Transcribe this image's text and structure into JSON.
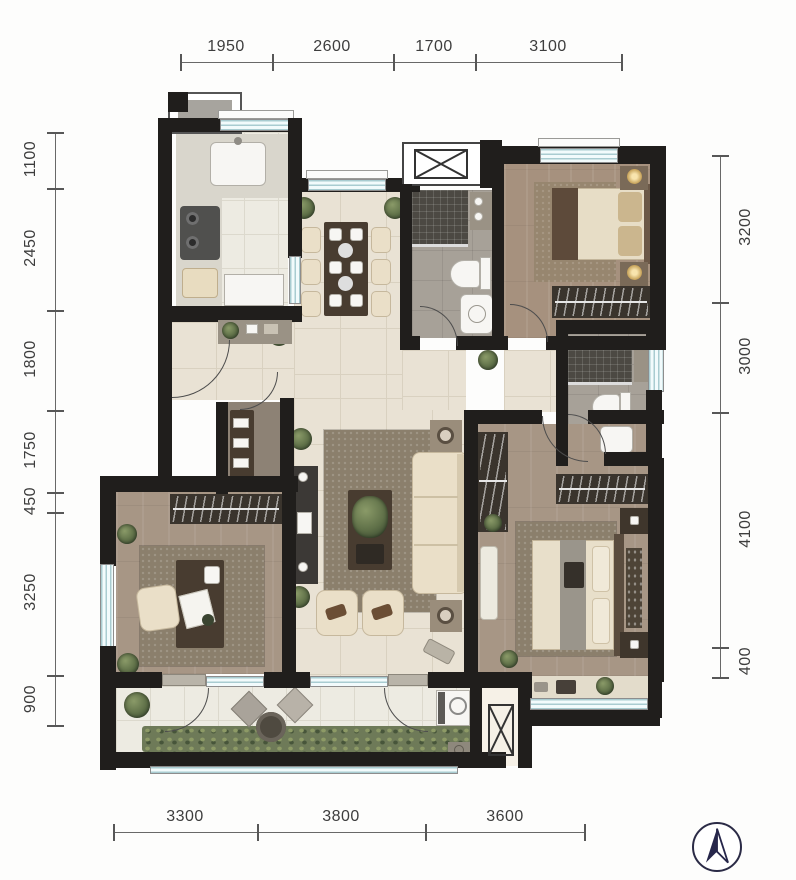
{
  "dimensions": {
    "top": [
      "1950",
      "2600",
      "1700",
      "3100"
    ],
    "left": [
      "1100",
      "2450",
      "1800",
      "1750",
      "450",
      "3250",
      "900"
    ],
    "right": [
      "3200",
      "3000",
      "4100",
      "400"
    ],
    "bottom": [
      "3300",
      "3800",
      "3600"
    ]
  },
  "compass": {
    "icon": "north-arrow"
  },
  "colors": {
    "wall": "#201e1c",
    "floor_tile_light": "#e9e2d4",
    "floor_wood": "#a6917e",
    "floor_bath": "#a7a198",
    "shower_tile": "#4c4943",
    "window_glass": "#f2fbfc",
    "plant_green": "#5f7048",
    "dimension_text": "#3d3d3d",
    "compass_navy": "#2b2b46"
  }
}
